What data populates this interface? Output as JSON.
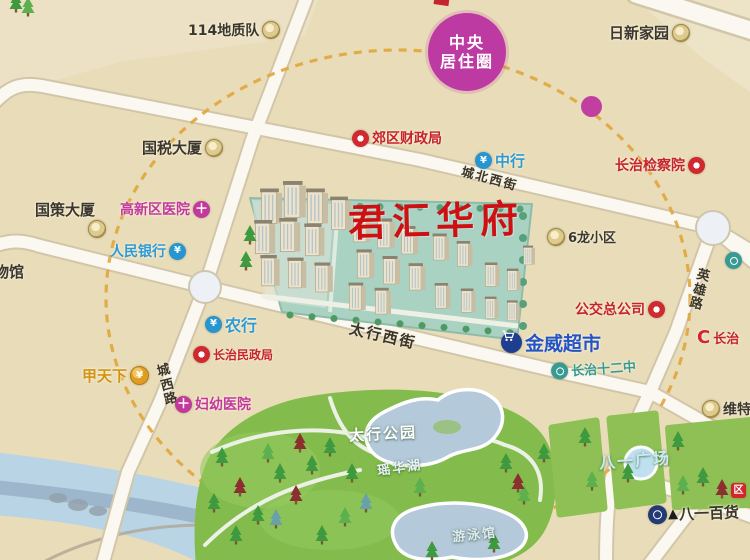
{
  "map": {
    "title": "君汇华府",
    "badge": {
      "line1": "中央",
      "line2": "居住圈"
    },
    "palette": {
      "background": "#e9dcb9",
      "road": "#faf8f1",
      "ring_dash": "#e0a63c",
      "park_green": "#83bc4c",
      "water": "#b7cfdf",
      "river": "#b9d4e4",
      "title_red": "#cd1113",
      "badge_purple": "#bd3aa2",
      "bank_blue": "#2d9ad3",
      "hospital_magenta": "#c2399c",
      "poi_red": "#c5242c",
      "school_teal": "#379b94",
      "supermarket_blue": "#2453c6",
      "gold": "#d29413"
    },
    "pois": [
      {
        "id": "dizhidui",
        "text": "114地质队",
        "x": 188,
        "y": 20,
        "color": "dark",
        "icon": "badge",
        "side": "right",
        "size": 14
      },
      {
        "id": "guoshui-dasha",
        "text": "国税大厦",
        "x": 142,
        "y": 137,
        "color": "dark",
        "icon": "badge",
        "side": "right",
        "size": 15
      },
      {
        "id": "rixin-jiayuan",
        "text": "日新家园",
        "x": 609,
        "y": 22,
        "color": "dark",
        "icon": "badge",
        "side": "right",
        "size": 15
      },
      {
        "id": "jiaoqu-caizhengju",
        "text": "郊区财政局",
        "x": 352,
        "y": 128,
        "color": "red",
        "icon": "donut",
        "side": "left",
        "size": 14
      },
      {
        "id": "zhonghang",
        "text": "中行",
        "x": 475,
        "y": 150,
        "color": "blue",
        "icon": "bank",
        "side": "left",
        "size": 15
      },
      {
        "id": "jianchayuan",
        "text": "长治检察院",
        "x": 615,
        "y": 155,
        "color": "red",
        "icon": "donut",
        "side": "right",
        "size": 14
      },
      {
        "id": "guoce-dasha",
        "text": "国策大厦",
        "x": 35,
        "y": 199,
        "color": "dark",
        "icon": "none",
        "side": "left",
        "size": 15
      },
      {
        "id": "guoce-badge",
        "text": "",
        "x": 88,
        "y": 220,
        "color": "dark",
        "icon": "badge",
        "side": "left",
        "size": 14
      },
      {
        "id": "gaoxinqu-yiyuan",
        "text": "高新区医院",
        "x": 120,
        "y": 199,
        "color": "magenta",
        "icon": "cross",
        "side": "right",
        "size": 14
      },
      {
        "id": "renmin-yinhang",
        "text": "人民银行",
        "x": 110,
        "y": 241,
        "color": "blue",
        "icon": "bank",
        "side": "right",
        "size": 14
      },
      {
        "id": "wuguan",
        "text": "物馆",
        "x": -6,
        "y": 261,
        "color": "dark",
        "icon": "none",
        "side": "left",
        "size": 15
      },
      {
        "id": "liulong-xiaoqu",
        "text": "6龙小区",
        "x": 547,
        "y": 227,
        "color": "dark",
        "icon": "badge",
        "side": "left",
        "size": 13
      },
      {
        "id": "gongjiao-zonggongsi",
        "text": "公交总公司",
        "x": 575,
        "y": 299,
        "color": "red",
        "icon": "donut",
        "side": "right",
        "size": 14
      },
      {
        "id": "nonghang",
        "text": "农行",
        "x": 205,
        "y": 312,
        "color": "blue",
        "icon": "bank",
        "side": "left",
        "size": 16
      },
      {
        "id": "minzhengju",
        "text": "长治民政局",
        "x": 193,
        "y": 346,
        "color": "red",
        "icon": "donut",
        "side": "left",
        "size": 12
      },
      {
        "id": "jiatianxia",
        "text": "甲天下",
        "x": 82,
        "y": 365,
        "color": "orange",
        "icon": "coin",
        "side": "right",
        "size": 15
      },
      {
        "id": "fuyou-yiyuan",
        "text": "妇幼医院",
        "x": 175,
        "y": 394,
        "color": "magenta",
        "icon": "cross",
        "side": "left",
        "size": 14
      },
      {
        "id": "jinwei-chaoshi",
        "text": "金威超市",
        "x": 501,
        "y": 329,
        "color": "royal",
        "icon": "cart",
        "side": "left",
        "size": 19
      },
      {
        "id": "shierzhong",
        "text": "长治十二中",
        "x": 551,
        "y": 359,
        "color": "teal",
        "icon": "tealc",
        "side": "left",
        "size": 13,
        "rot": -4
      },
      {
        "id": "weite",
        "text": "维特",
        "x": 702,
        "y": 399,
        "color": "dark",
        "icon": "badge",
        "side": "left",
        "size": 14
      },
      {
        "id": "bayi-baihuo",
        "text": "八一百货",
        "x": 648,
        "y": 503,
        "color": "dark",
        "icon": "store",
        "side": "left",
        "size": 15,
        "extra": "triangle",
        "rot": -2
      },
      {
        "id": "edge-teal-marker",
        "text": "",
        "x": 725,
        "y": 252,
        "color": "teal",
        "icon": "tealc",
        "side": "left",
        "size": 13
      },
      {
        "id": "edge-changzhi",
        "text": "长治",
        "x": 697,
        "y": 328,
        "color": "red",
        "icon": "clogo",
        "side": "left",
        "size": 13
      },
      {
        "id": "edge-red-marker",
        "text": "",
        "x": 731,
        "y": 483,
        "color": "red",
        "icon": "redsq",
        "side": "left",
        "size": 11
      }
    ],
    "streets": [
      {
        "id": "chengbei-xijie",
        "text": "城北西街",
        "x": 461,
        "y": 168,
        "rot": 15,
        "size": 12.5,
        "vertical": false
      },
      {
        "id": "taihang-xijie",
        "text": "太行西街",
        "x": 349,
        "y": 325,
        "rot": 13,
        "size": 15,
        "vertical": false
      },
      {
        "id": "yingxiong-lu",
        "text": "英雄路",
        "x": 692,
        "y": 269,
        "rot": 14,
        "size": 13,
        "vertical": true
      },
      {
        "id": "chengxi-lu",
        "text": "城西路",
        "x": 160,
        "y": 364,
        "rot": -14,
        "size": 13,
        "vertical": true
      }
    ],
    "areas": [
      {
        "id": "taihang-gongyuan",
        "text": "太行公园",
        "x": 349,
        "y": 423,
        "size": 15,
        "rot": -3,
        "color": "#ffffff"
      },
      {
        "id": "yaohua-hu",
        "text": "瑶华湖",
        "x": 377,
        "y": 457,
        "size": 13,
        "rot": -8,
        "color": "#e8f2f7"
      },
      {
        "id": "youyongguan",
        "text": "游泳馆",
        "x": 452,
        "y": 524,
        "size": 13,
        "rot": -6,
        "color": "#dfeaf2"
      },
      {
        "id": "bayi-guangchang",
        "text": "八一广场",
        "x": 599,
        "y": 447,
        "size": 16,
        "rot": -4,
        "color": "#c8ecf6"
      }
    ]
  }
}
